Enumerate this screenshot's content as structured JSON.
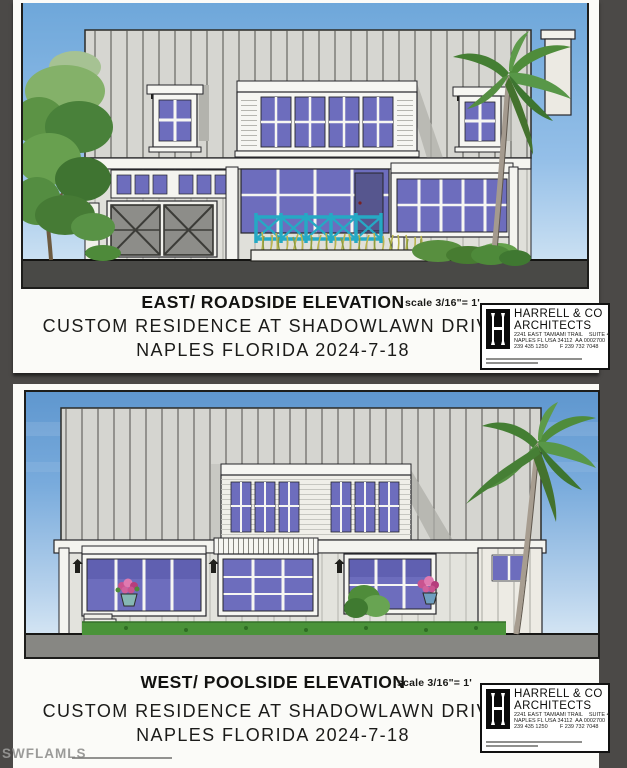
{
  "photo": {
    "watermark": "SWFLAMLS"
  },
  "colors": {
    "background": "#4b4947",
    "sheet_white": "#fbfbf8",
    "sky_blue_east": "#7fb0de",
    "sky_blue_west": "#5f97cf",
    "siding_gray": "#d6d6d1",
    "window_purple": "#6d6dbd",
    "railing_teal": "#25a9c4",
    "grass_green": "#4a9339",
    "ground_dark": "#494946",
    "ground_light": "#878783"
  },
  "stamp": {
    "monogram": "H",
    "firm_line1": "HARRELL & CO",
    "firm_line2": "ARCHITECTS",
    "address_line1": "2241 EAST TAMIAMI TRAIL    SUITE 4",
    "address_line2": "NAPLES FL USA 34112  AA 0002700",
    "phone_line": "239 435 1250        F 239 732 7048"
  },
  "panels": [
    {
      "title": "EAST/ ROADSIDE ELEVATION",
      "scale_label": "scale 3/16\"= 1'",
      "address_line1": "CUSTOM RESIDENCE AT SHADOWLAWN DRIVE",
      "address_line2": "NAPLES FLORIDA  2024-7-18"
    },
    {
      "title": "WEST/ POOLSIDE ELEVATION",
      "scale_label": "scale 3/16\"= 1'",
      "address_line1": "CUSTOM RESIDENCE AT SHADOWLAWN DRIVE",
      "address_line2": "NAPLES FLORIDA  2024-7-18"
    }
  ]
}
